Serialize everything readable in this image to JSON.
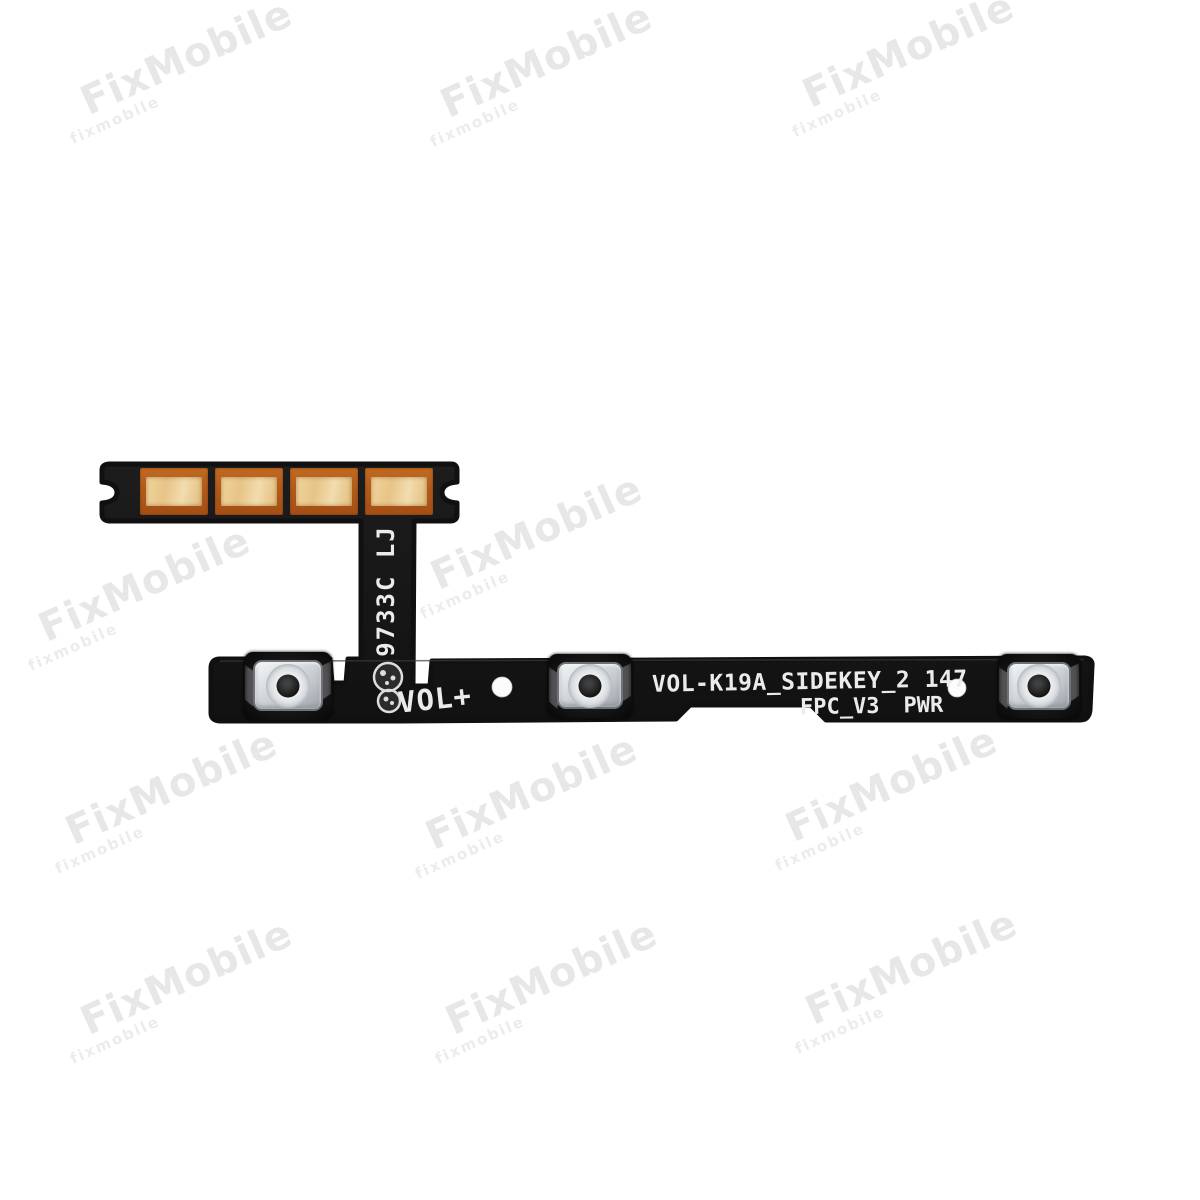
{
  "photo": {
    "background": "#ffffff"
  },
  "watermark": {
    "text": "FixMobile",
    "subtext": "fixmobile",
    "rotation_deg": -24,
    "color": "rgba(212,212,212,0.55)",
    "positions": [
      {
        "x": 190,
        "y": 65
      },
      {
        "x": 550,
        "y": 68
      },
      {
        "x": 912,
        "y": 58
      },
      {
        "x": 148,
        "y": 592
      },
      {
        "x": 540,
        "y": 540
      },
      {
        "x": 175,
        "y": 795
      },
      {
        "x": 535,
        "y": 800
      },
      {
        "x": 895,
        "y": 792
      },
      {
        "x": 190,
        "y": 985
      },
      {
        "x": 555,
        "y": 985
      },
      {
        "x": 915,
        "y": 975
      }
    ]
  },
  "flex": {
    "colors": {
      "body": "#181818",
      "edge": "#101010",
      "pad_copper": "#b05a1c",
      "pad_gold": "#ecce96",
      "print": "#ebebeb",
      "button_metal": "#d7dbde",
      "hole_white": "#fcfcfc"
    },
    "labels": {
      "batch_vertical": "9733C LJ",
      "vol_plus": "VOL+",
      "part_line": "VOL-K19A_SIDEKEY_2 147",
      "fpc_label": "FPC_V3",
      "pwr_label": "PWR"
    },
    "pads": [
      {
        "x": 140,
        "y": 468
      },
      {
        "x": 215,
        "y": 468
      },
      {
        "x": 290,
        "y": 468
      },
      {
        "x": 365,
        "y": 468
      }
    ],
    "buttons": [
      {
        "name": "tactile-switch-volume-up",
        "x": 244,
        "y": 652,
        "w": 88,
        "h": 68
      },
      {
        "name": "tactile-switch-volume-down",
        "x": 548,
        "y": 654,
        "w": 84,
        "h": 64
      },
      {
        "name": "tactile-switch-power",
        "x": 998,
        "y": 654,
        "w": 82,
        "h": 65
      }
    ],
    "holes": [
      {
        "cx": 502,
        "cy": 687,
        "r": 10
      },
      {
        "cx": 957,
        "cy": 688,
        "r": 9
      }
    ]
  }
}
